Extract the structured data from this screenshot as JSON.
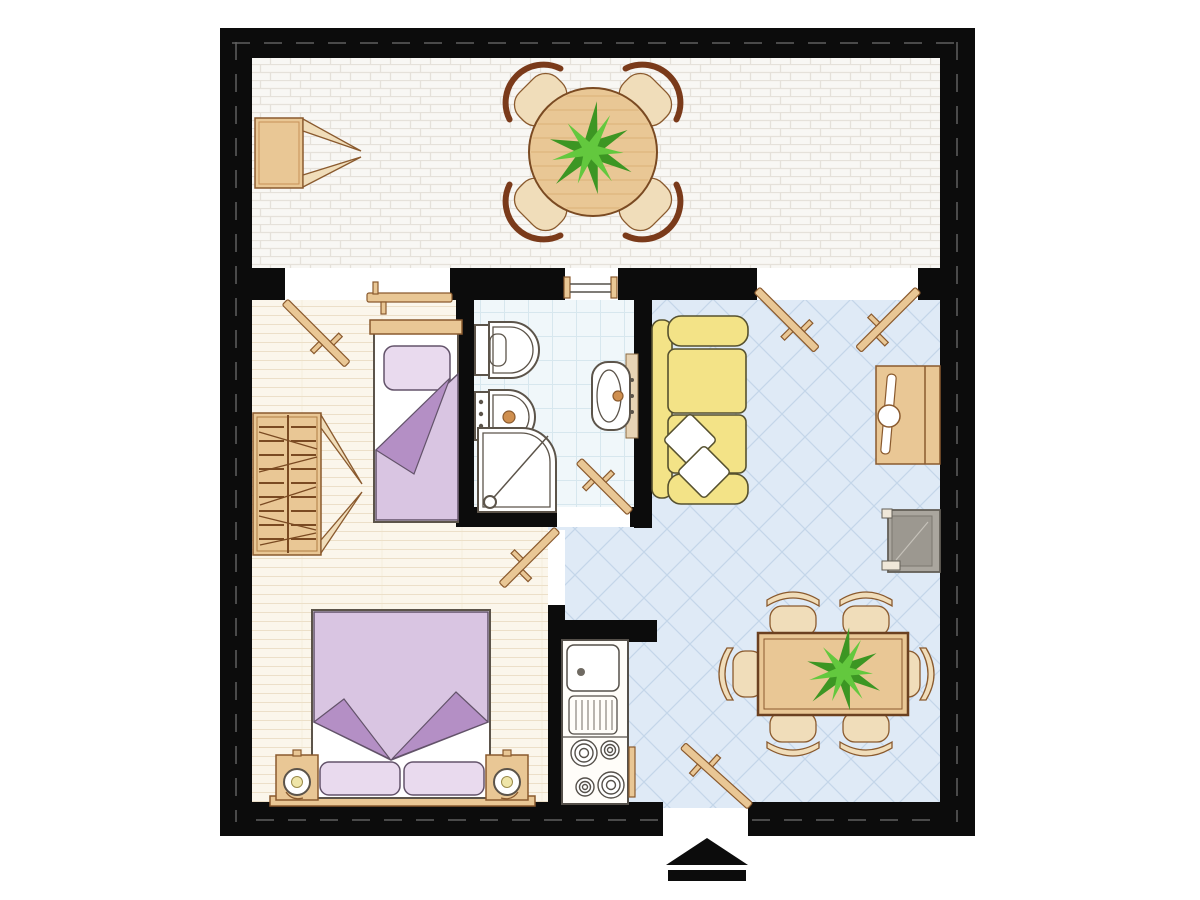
{
  "document": {
    "kind": "apartment-floor-plan",
    "view": "top-down",
    "text_labels": []
  },
  "colors": {
    "wall": "#0c0c0c",
    "wall_dash": "#6f6f6f",
    "bg": "#ffffff",
    "terrace_floor": "#f8f7f4",
    "terrace_joint": "#e5e1da",
    "bedroom_floor": "#fbf6eb",
    "bedroom_line": "#ecdfc8",
    "bath_floor": "#f0f7fa",
    "bath_line": "#d7e7ee",
    "living_floor": "#dfeaf6",
    "living_line": "#c3d6e9",
    "wood": "#e9c795",
    "wood_light": "#f0ddba",
    "wood_dark": "#8a5a2e",
    "fixture_stroke": "#5c544a",
    "sofa": "#f3e387",
    "sofa_stroke": "#56512f",
    "purple_light": "#d9c5e2",
    "purple_mid": "#b48fc5",
    "pillow": "#e9daee",
    "pillow_stroke": "#63536a",
    "armchair": "#aaa69e",
    "armchair_dark": "#9c9890",
    "plant_dark": "#3c9623",
    "plant_light": "#63c83e",
    "lamp_center": "#efe5a8",
    "chair_back": "#7a3a1a"
  },
  "rooms": [
    {
      "name": "terrace",
      "floor": "white-brick",
      "furniture": [
        "storage-cabinet-open-doors",
        "round-table",
        "plant",
        "four-chairs"
      ]
    },
    {
      "name": "bedroom-single",
      "floor": "wood-planks",
      "furniture": [
        "wardrobe-with-hangers",
        "single-bed-purple"
      ]
    },
    {
      "name": "bathroom",
      "floor": "square-tiles",
      "furniture": [
        "toilet",
        "bidet",
        "shower-corner",
        "washbasin"
      ]
    },
    {
      "name": "living-room",
      "floor": "diagonal-tiles",
      "furniture": [
        "yellow-sofa-two-pillows",
        "tv-cabinet",
        "grey-armchair",
        "dining-table-six-chairs",
        "plant"
      ]
    },
    {
      "name": "kitchen-niche",
      "floor": "diagonal-tiles",
      "furniture": [
        "sink-unit",
        "drainer",
        "four-burner-stove",
        "oven-handle"
      ]
    },
    {
      "name": "bedroom-double",
      "floor": "wood-planks",
      "furniture": [
        "double-bed-purple",
        "nightstand-left",
        "nightstand-right",
        "two-lamps"
      ]
    }
  ],
  "openings": {
    "doors": [
      "terrace-bedroom-french-door",
      "terrace-living-french-doors",
      "bathroom-door",
      "hall-door",
      "entrance-door"
    ],
    "window": "bathroom-terrace-window",
    "entrance_marker": "black-arrow-up"
  }
}
